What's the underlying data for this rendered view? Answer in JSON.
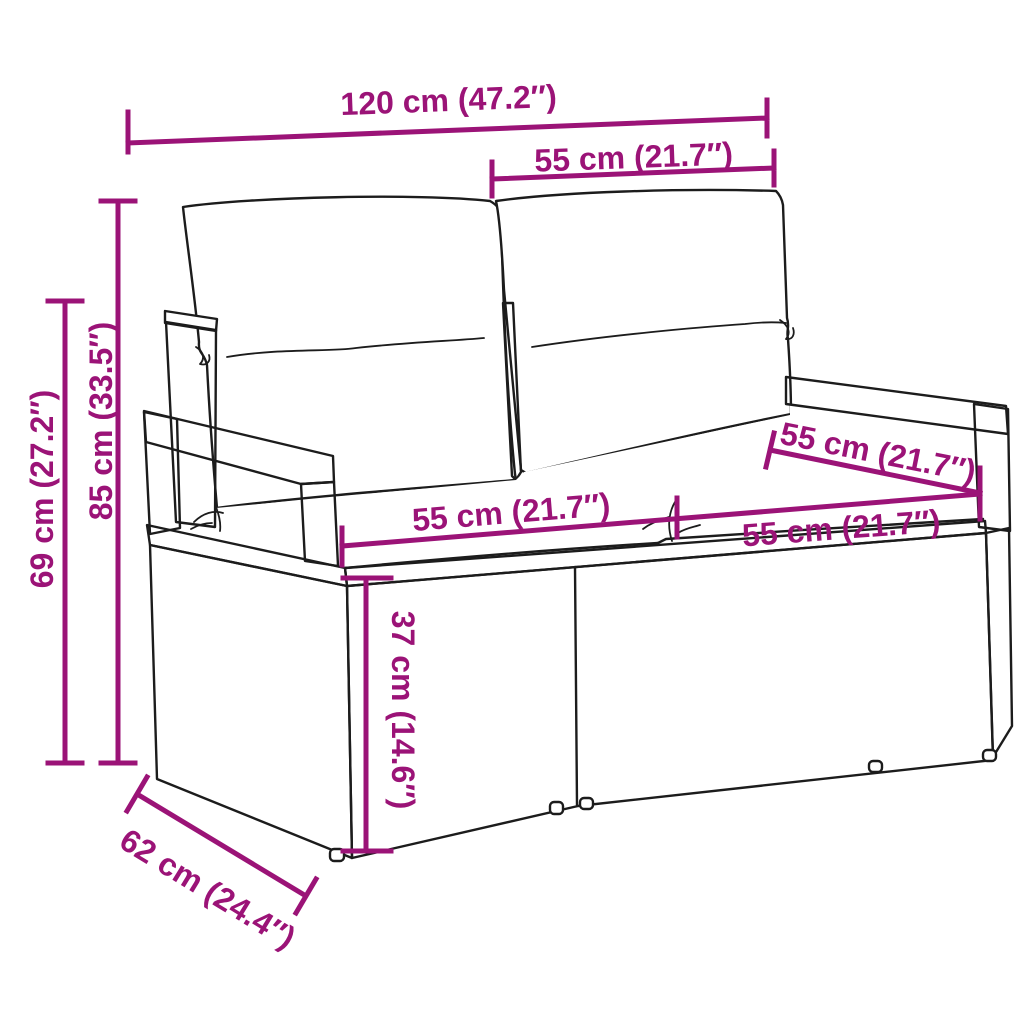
{
  "colors": {
    "dimension": "#9b1377",
    "outline": "#1c1c1c",
    "canvas": "#ffffff"
  },
  "dimensions": {
    "overall_width": {
      "cm": 120,
      "in": 47.2,
      "label": "120 cm (47.2″)"
    },
    "backrest_cushion_width": {
      "cm": 55,
      "in": 21.7,
      "label": "55 cm (21.7″)"
    },
    "total_height": {
      "cm": 85,
      "in": 33.5,
      "label": "85 cm (33.5″)"
    },
    "armrest_height": {
      "cm": 69,
      "in": 27.2,
      "label": "69 cm (27.2″)"
    },
    "seat_width_left": {
      "cm": 55,
      "in": 21.7,
      "label": "55 cm (21.7″)"
    },
    "seat_width_right": {
      "cm": 55,
      "in": 21.7,
      "label": "55 cm (21.7″)"
    },
    "seat_depth": {
      "cm": 55,
      "in": 21.7,
      "label": "55 cm (21.7″)"
    },
    "seat_height": {
      "cm": 37,
      "in": 14.6,
      "label": "37 cm (14.6″)"
    },
    "overall_depth": {
      "cm": 62,
      "in": 24.4,
      "label": "62 cm (24.4″)"
    }
  }
}
